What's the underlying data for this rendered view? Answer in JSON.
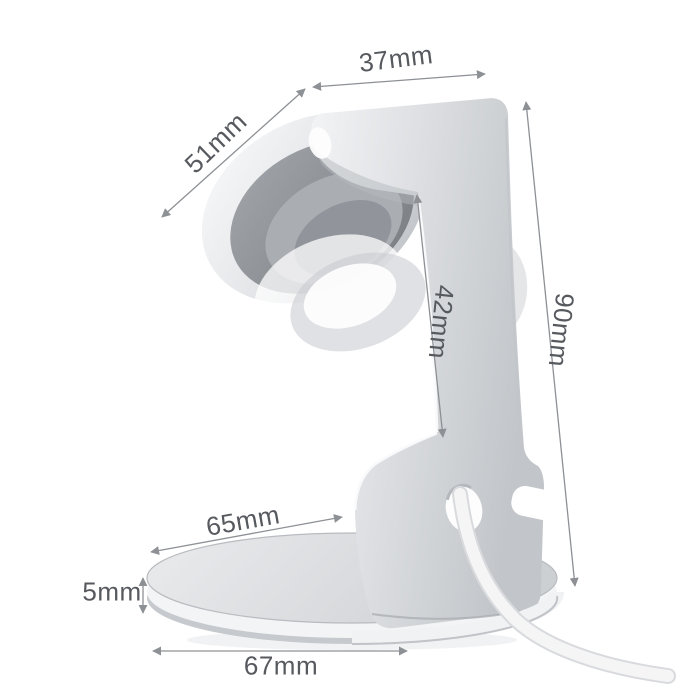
{
  "diagram": {
    "background_color": "#ffffff",
    "dimension_line_color": "#8d9094",
    "dimension_text_color": "#56595e",
    "metal_color": "#d6d8db",
    "pad_color": "#8e9297",
    "dimensions": [
      {
        "id": "top-width",
        "label": "37mm",
        "value": 37,
        "unit": "mm"
      },
      {
        "id": "holder-width",
        "label": "51mm",
        "value": 51,
        "unit": "mm"
      },
      {
        "id": "holder-height",
        "label": "42mm",
        "value": 42,
        "unit": "mm"
      },
      {
        "id": "total-height",
        "label": "90mm",
        "value": 90,
        "unit": "mm"
      },
      {
        "id": "base-depth",
        "label": "65mm",
        "value": 65,
        "unit": "mm"
      },
      {
        "id": "base-thickness",
        "label": "5mm",
        "value": 5,
        "unit": "mm"
      },
      {
        "id": "base-width",
        "label": "67mm",
        "value": 67,
        "unit": "mm"
      }
    ]
  }
}
